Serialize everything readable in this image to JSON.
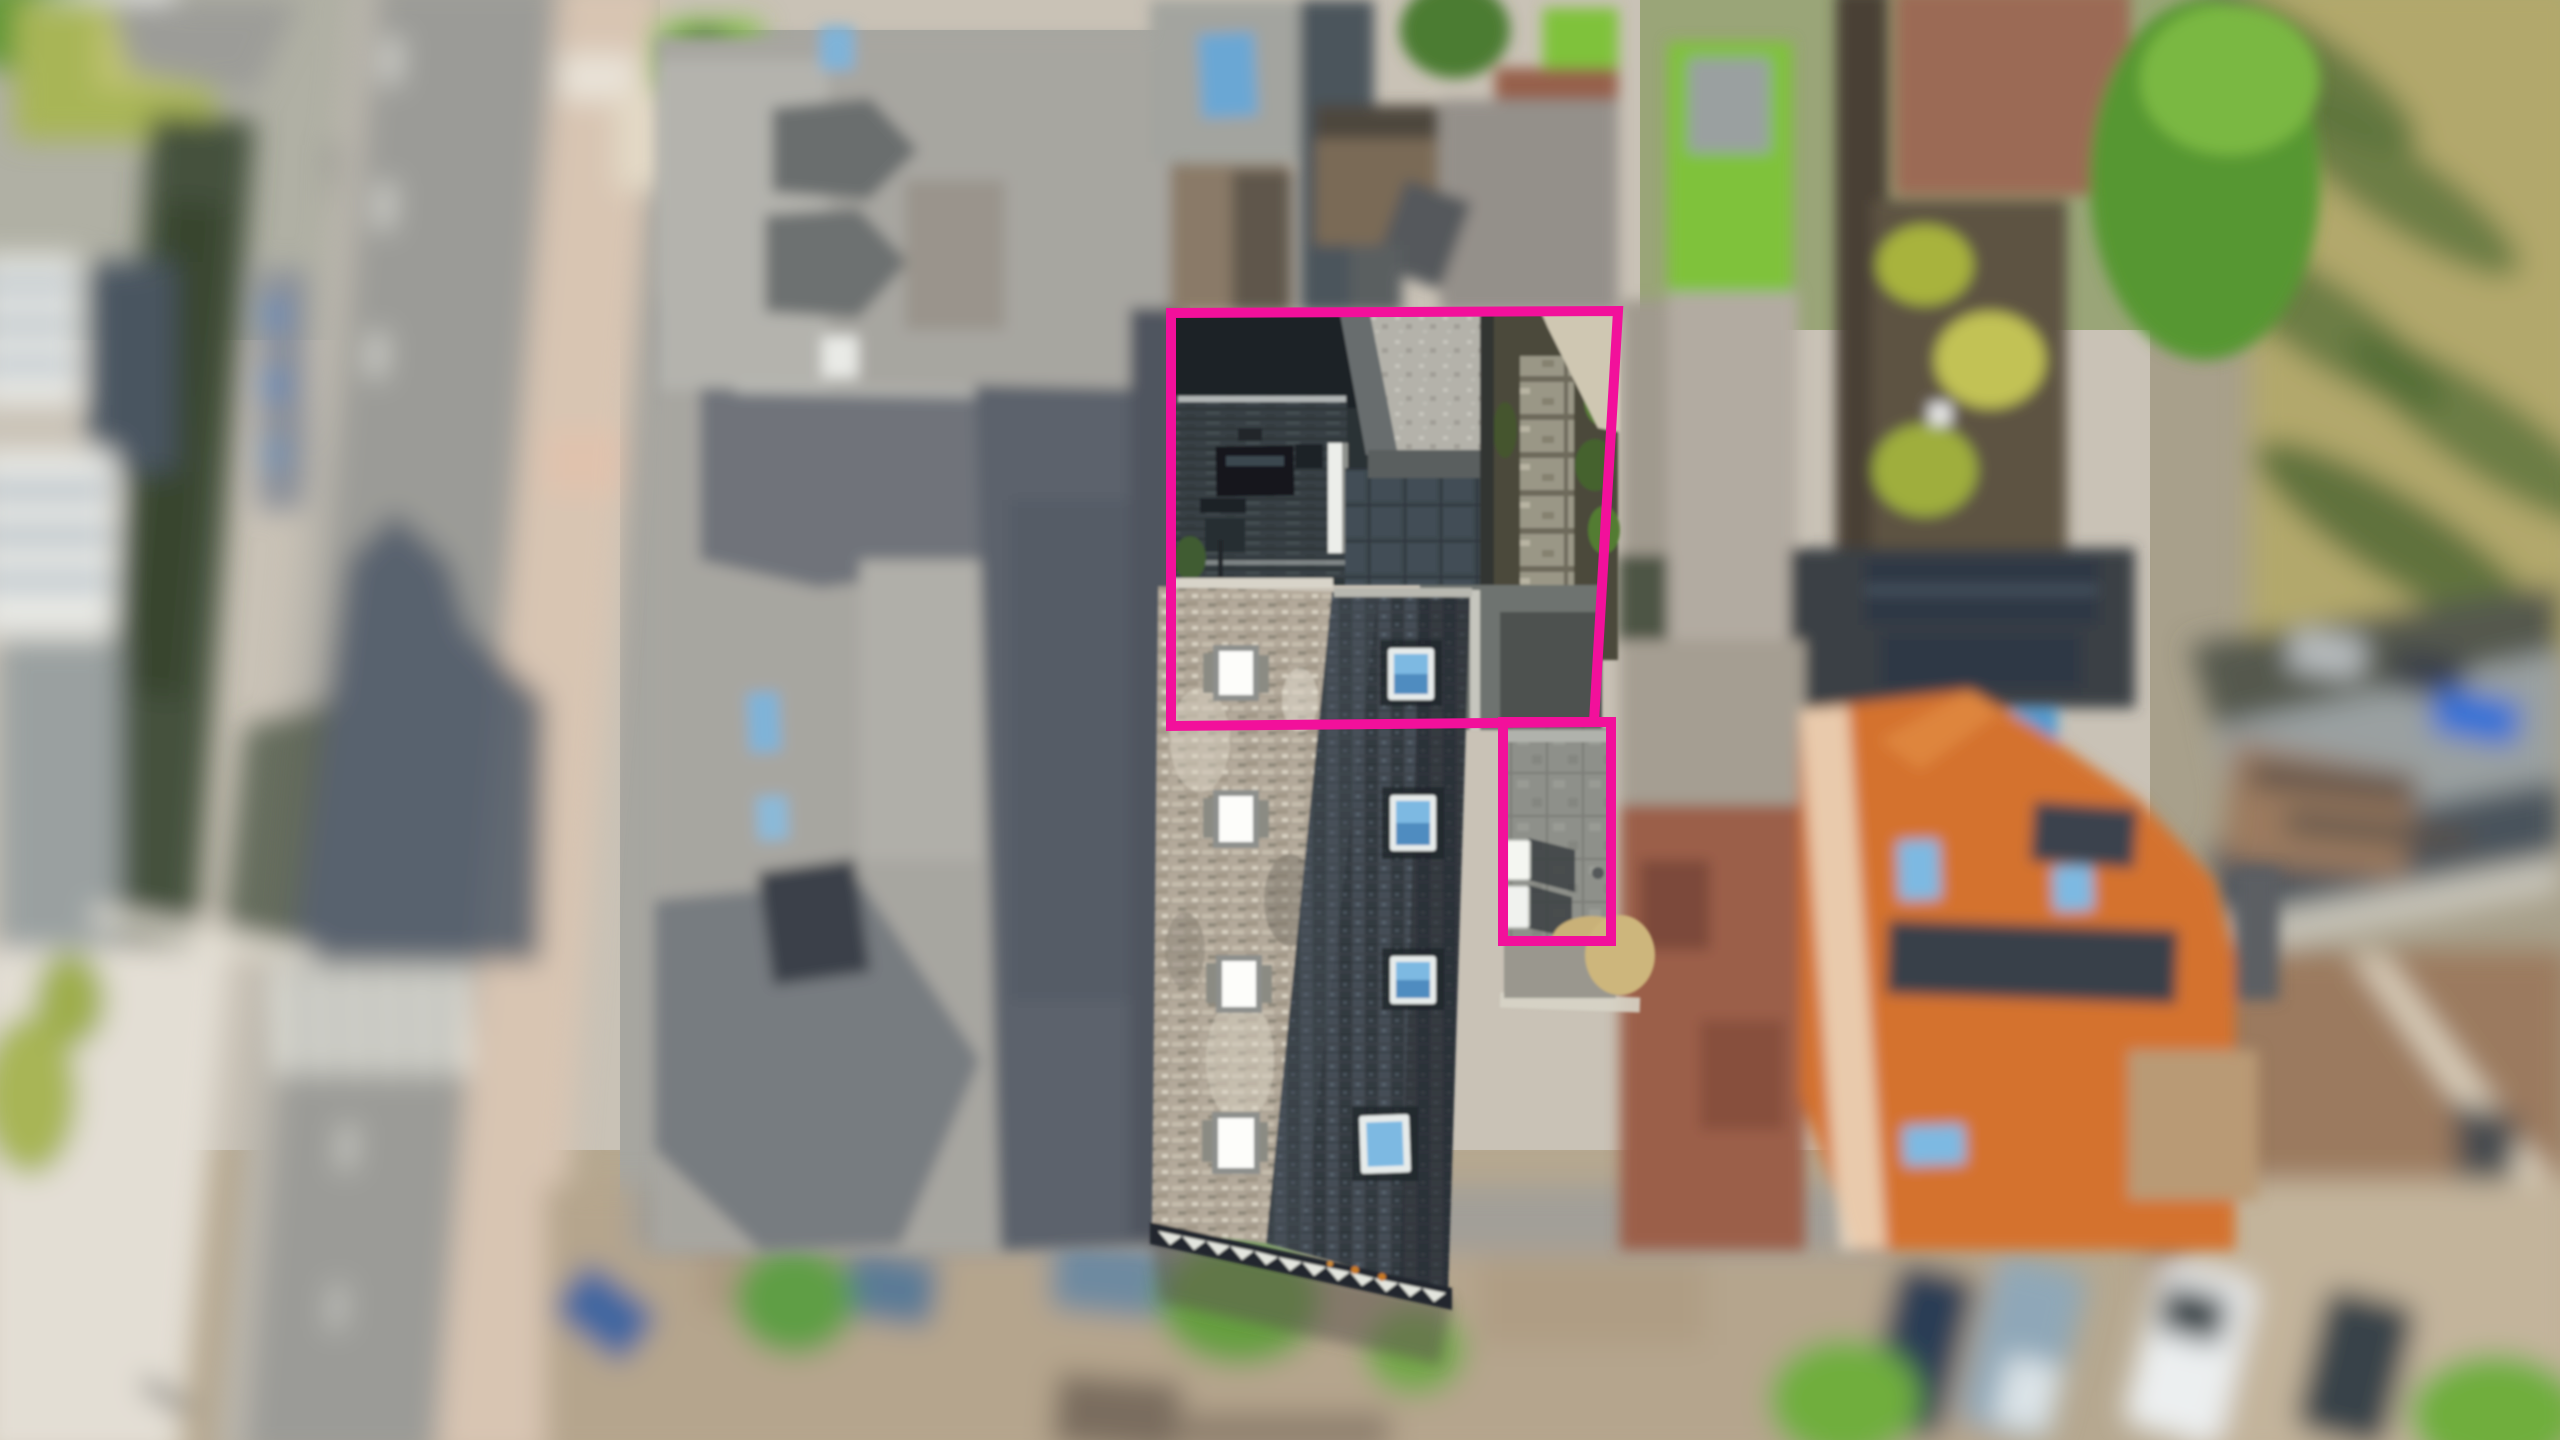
{
  "meta": {
    "kind": "aerial-drone-photograph",
    "description": "Top-down drone photo of a rowhouse property; two plots highlighted with a pink boundary outline; tilt-shift style blur with only the subject property in sharp focus.",
    "image_width": 2560,
    "image_height": 1440
  },
  "annotation": {
    "name": "plot-boundary-highlight",
    "color": "#F2109B",
    "stroke_width": 10,
    "plots": [
      {
        "name": "main-plot",
        "points": "1171,313 1618,311 1594,722 1171,726"
      },
      {
        "name": "annex-plot",
        "points": "1503,722 1611,722 1611,941 1503,941"
      }
    ]
  },
  "colors": {
    "pavement_light": "#cfc8bc",
    "road_asphalt": "#9b9b97",
    "road_shadow": "#4e5866",
    "sidewalk_pink": "#d8c5b2",
    "crosswalk_white": "#e2e2da",
    "lane_dash": "#d9d9d3",
    "grass_lawn": "#7fc23a",
    "grass_patch": "#a8b556",
    "grass_dry_field": "#b2a86c",
    "tree_green": "#569733",
    "tree_shadow": "#4e6b35",
    "hedge_dark": "#45513d",
    "complex_gray": "#a7a6a0",
    "complex_dark_roof": "#6f737a",
    "complex_shadow_side": "#5c626c",
    "slate_roof": "#3c424a",
    "weathered_roof": "#b3a99a",
    "flat_concrete": "#b4b2aa",
    "deck_dark": "#2c3235",
    "garden_soil": "#4b4a3b",
    "garden_path": "#8f8c7c",
    "orange_roof": "#d4722f",
    "old_red_roof": "#9b5f4a",
    "brown_roof_right": "#9b7a5e",
    "solar_panel": "#2e3844",
    "skylight_blue": "#7db9e2",
    "skylight_white": "#f4f6f1",
    "white_chimney": "#eceeea",
    "street_tan": "#b5a58d",
    "car_navy": "#2c3c55",
    "car_steel": "#8fa7b8",
    "car_white": "#eceff0",
    "car_dark": "#394349",
    "car_blue": "#2f6fd8",
    "car_slate_blue": "#5a7a96",
    "straw": "#c9b178",
    "annex_slab": "#8e908a"
  }
}
